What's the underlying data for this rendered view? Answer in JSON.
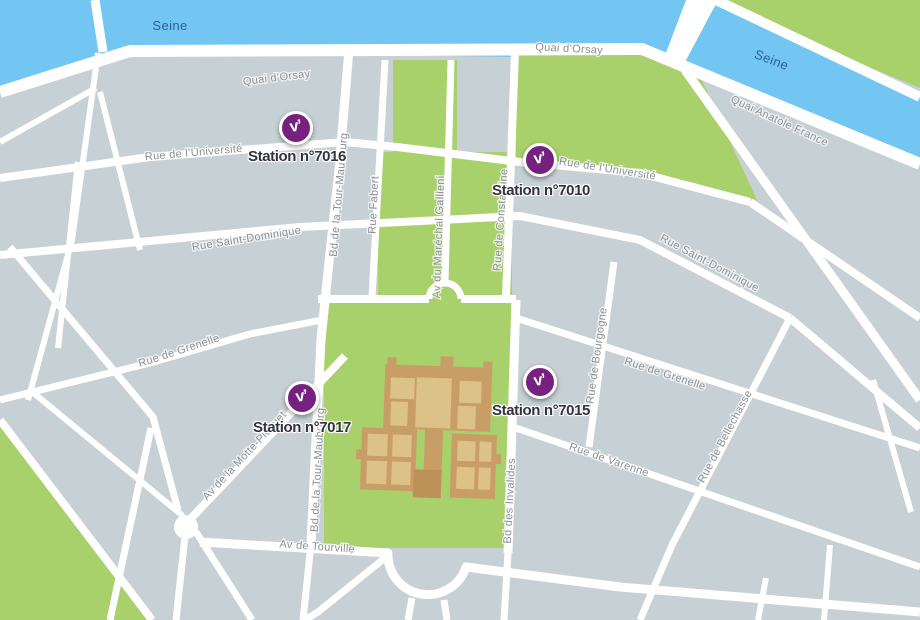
{
  "marker_glyph": "v’",
  "river": {
    "name": "Seine"
  },
  "streets": {
    "quai_dorsay": "Quai d’Orsay",
    "quai_anatole_france": "Quai Anatole France",
    "universite": "Rue de l’Université",
    "saint_dominique": "Rue Saint-Dominique",
    "grenelle": "Rue de Grenelle",
    "varenne": "Rue de Varenne",
    "bellechasse": "Rue de Bellechasse",
    "bourgogne": "Rue de Bourgogne",
    "constantine": "Rue de Constantine",
    "fabert": "Rue Fabert",
    "gallieni": "Av du Maréchal Gallieni",
    "tour_maubourg": "Bd de la Tour-Maubourg",
    "invalides_bd": "Bd des Invalides",
    "tourville": "Av de Tourville",
    "motte_picquet": "Av de la Motte-Picquet"
  },
  "stations": [
    {
      "id": "7016",
      "label": "Station n°7016"
    },
    {
      "id": "7010",
      "label": "Station n°7010"
    },
    {
      "id": "7017",
      "label": "Station n°7017"
    },
    {
      "id": "7015",
      "label": "Station n°7015"
    }
  ],
  "colors": {
    "water": "#72c6f1",
    "park": "#a8d06b",
    "land": "#c7d0d5",
    "road": "#ffffff",
    "building_wall": "#c89e66",
    "building_courtyard": "#ddc287",
    "building_dome": "#bd9158",
    "marker_purple": "#76207f",
    "river_label": "#2b5f9e",
    "street_label": "#898f94",
    "station_label": "#32333d"
  }
}
